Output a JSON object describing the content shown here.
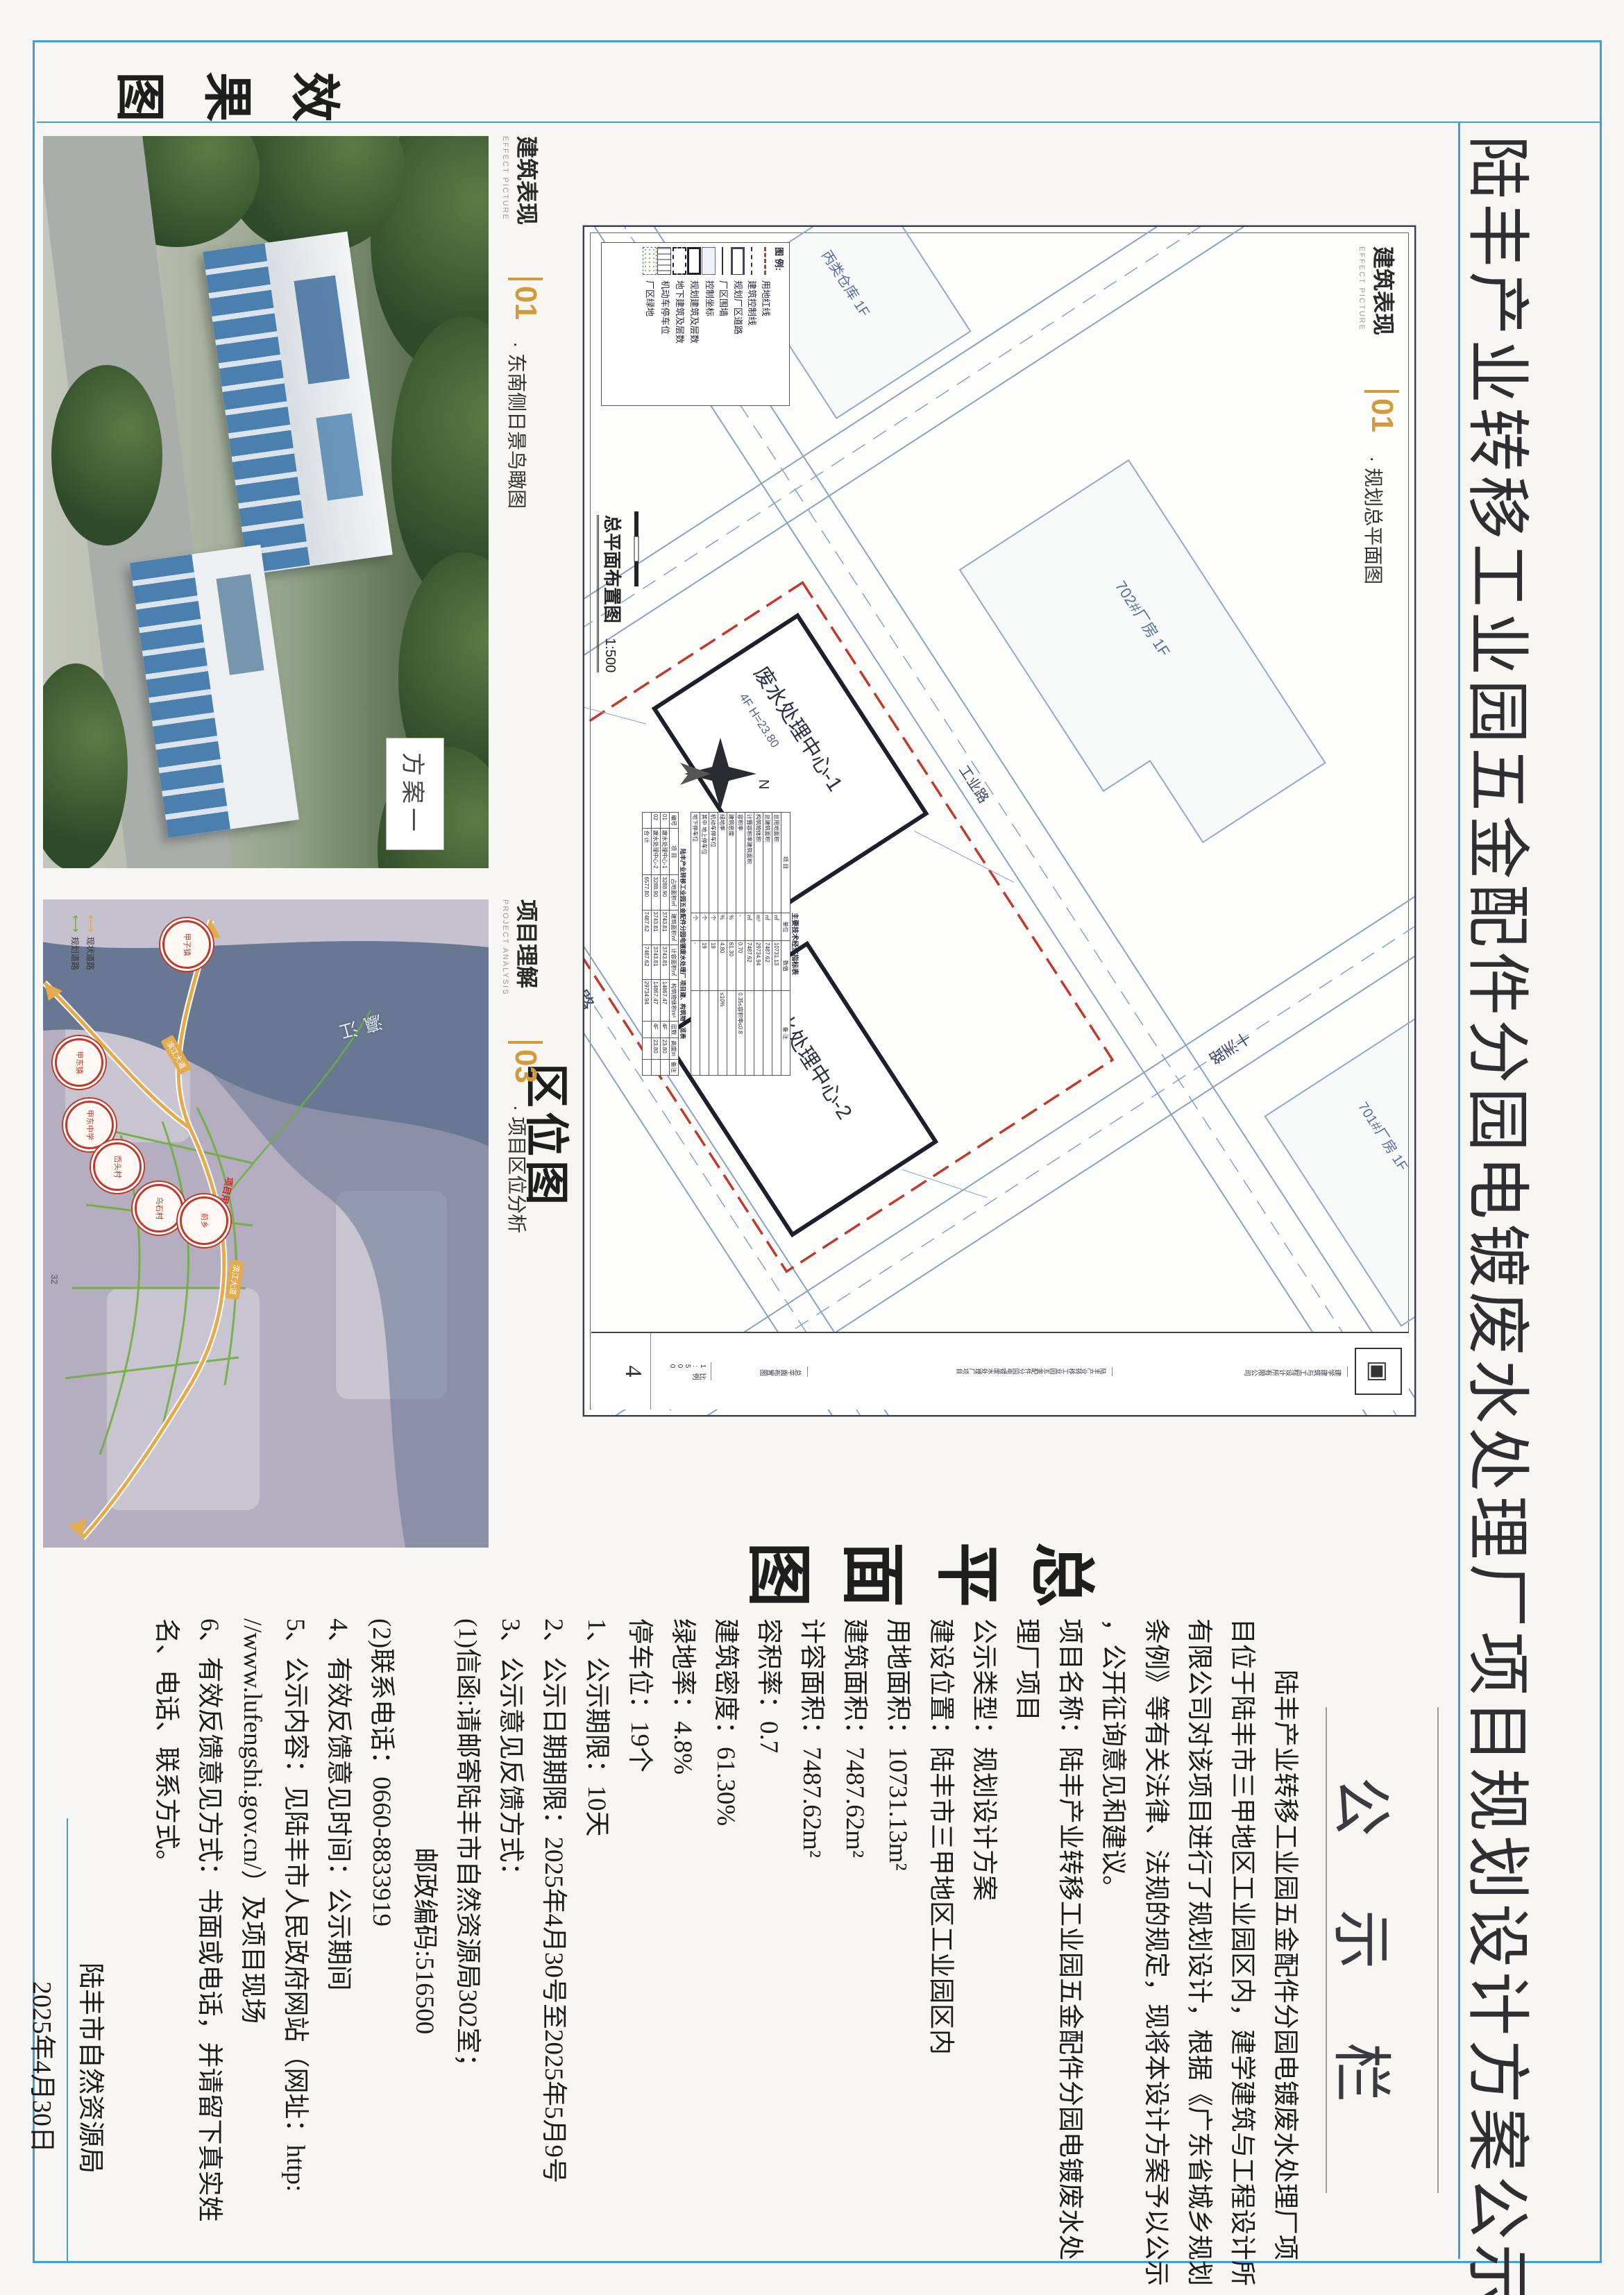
{
  "page": {
    "title": "陆丰产业转移工业园五金配件分园电镀废水处理厂项目规划设计方案公示"
  },
  "section_labels": {
    "effect": "效果图",
    "location": "区位图",
    "siteplan": "总平面图"
  },
  "bands": {
    "effect": {
      "cn": "建筑表现",
      "en": "EFFECT PICTURE",
      "num": "01",
      "sub": "· 东南侧日景鸟瞰图",
      "scheme_tag": "方案一"
    },
    "analysis": {
      "cn": "项目理解",
      "en": "PROJECT ANALYSIS",
      "num": "03",
      "sub": "· 项目区位分析",
      "page_no": "32"
    },
    "sheet": {
      "cn": "建筑表现",
      "en": "EFFECT PICTURE",
      "num": "01",
      "sub": "· 规划总平面图"
    }
  },
  "map": {
    "water": "瀛江",
    "road_badge1": "滨江大道",
    "road_badge2": "滨江大道",
    "plot": "项目用地",
    "legend_existing": "现状道路",
    "legend_planned": "规划道路",
    "circles": [
      "甲子镇",
      "甲东镇",
      "甲东中学",
      "岙头村",
      "乌石村",
      "前乡"
    ]
  },
  "sheet": {
    "legend_title": "图 例:",
    "legend": [
      "用地红线",
      "建筑控制线",
      "规划厂区道路",
      "厂区围墙",
      "控制坐标",
      "规划建筑及层数",
      "地下建筑及层数",
      "机动车停车位",
      "厂区绿地"
    ],
    "drawing_title": "总平面布置图",
    "drawing_scale": "1:500",
    "north": "N",
    "bldg1": "废水处理中心-1",
    "bldg1_info": "4F  H=23.80",
    "bldg2": "废水处理中心-2",
    "bldg2_info": "4F  H=23.80",
    "nb1": "702#厂房 1F",
    "nb2": "701#厂房 1F",
    "nb3": "丙类仓库 1F",
    "nb4": "乙类厂房 1F",
    "nb5": "在建厂房",
    "road1": "工  业  路",
    "road2": "十洲路",
    "road3": "工业路",
    "table1": {
      "title": "主要技术经济指标表",
      "headers": [
        "项 目",
        "单位",
        "数值",
        "备 注"
      ],
      "rows": [
        {
          "item": "总用地面积",
          "unit": "㎡",
          "value": "10731.13",
          "note": ""
        },
        {
          "item": "总建筑面积",
          "unit": "㎡",
          "value": "7487.62",
          "note": ""
        },
        {
          "item": "构筑物体积",
          "unit": "m³",
          "value": "29734.94",
          "note": ""
        },
        {
          "item": "计算容积率建筑面积",
          "unit": "㎡",
          "value": "7487.62",
          "note": ""
        },
        {
          "item": "容积率",
          "unit": "-",
          "value": "0.70",
          "note": "0.35≤容积率≤0.8"
        },
        {
          "item": "建筑密度",
          "unit": "%",
          "value": "61.30",
          "note": ""
        },
        {
          "item": "绿地率",
          "unit": "%",
          "value": "4.80",
          "note": "≤10%"
        },
        {
          "item": "机动车停车位",
          "unit": "个",
          "value": "19",
          "note": ""
        },
        {
          "item": "其中 地上停车位",
          "unit": "个",
          "value": "19",
          "note": ""
        },
        {
          "item": "地下停车位",
          "unit": "个",
          "value": "-",
          "note": ""
        }
      ]
    },
    "table2": {
      "title": "陆丰产业转移工业园五金配件分园电镀废水处理厂 项目建、构筑物一览表",
      "headers": [
        "编号",
        "项 目",
        "占地面积㎡",
        "建筑面积㎡",
        "计容面积㎡",
        "构筑物体积m³",
        "层数",
        "高度m",
        "备注"
      ],
      "rows": [
        [
          "01",
          "废水处理中心-1",
          "3288.90",
          "3743.81",
          "3743.81",
          "14867.47",
          "4F",
          "23.80",
          ""
        ],
        [
          "02",
          "废水处理中心-2",
          "3288.90",
          "3743.81",
          "3743.81",
          "14867.47",
          "4F",
          "23.80",
          ""
        ],
        [
          "",
          "合 计",
          "6577.80",
          "7487.62",
          "7487.62",
          "29734.94",
          "",
          "",
          ""
        ]
      ]
    },
    "titleblock": {
      "company": "建学建筑与工程设计所有限公司",
      "project": "陆丰产业转移工业园五金配件分园电镀废水处理厂项目",
      "drawing": "总平面布置图",
      "scale": "比例 1:500",
      "no": "图号 4",
      "sheet_no": "4"
    }
  },
  "announcement": {
    "header": "公 示 栏",
    "lines": [
      "　　陆丰产业转移工业园五金配件分园电镀废水处理厂项",
      "目位于陆丰市三甲地区工业园区内，建学建筑与工程设计所",
      "有限公司对该项目进行了规划设计，根据《广东省城乡规划",
      "条例》等有关法律、法规的规定，现将本设计方案予以公示",
      "，公开征询意见和建议。",
      "项目名称：陆丰产业转移工业园五金配件分园电镀废水处",
      "理厂项目",
      "公示类型：规划设计方案",
      "建设位置：陆丰市三甲地区工业园区内",
      "用地面积：10731.13m²",
      "建筑面积：7487.62m²",
      "计容面积：7487.62m²",
      "容积率：0.7",
      "建筑密度：61.30%",
      "绿地率：4.8%",
      "停车位：19个",
      "1、公示期限：10天",
      "2、公示日期期限：2025年4月30号至2025年5月9号",
      "3、公示意见反馈方式：",
      "(1)信函:请邮寄陆丰市自然资源局302室；",
      "邮政编码:516500",
      "(2)联系电话：0660-8833919",
      "4、有效反馈意见时间：公示期间",
      "5、公示内容：见陆丰市人民政府网站（网址：http:",
      "//www.lufengshi.gov.cn/）及项目现场",
      "6、有效反馈意见方式：书面或电话，并请留下真实姓",
      "名、电话、联系方式。"
    ],
    "agency": "陆丰市自然资源局",
    "date": "2025年4月30日"
  }
}
